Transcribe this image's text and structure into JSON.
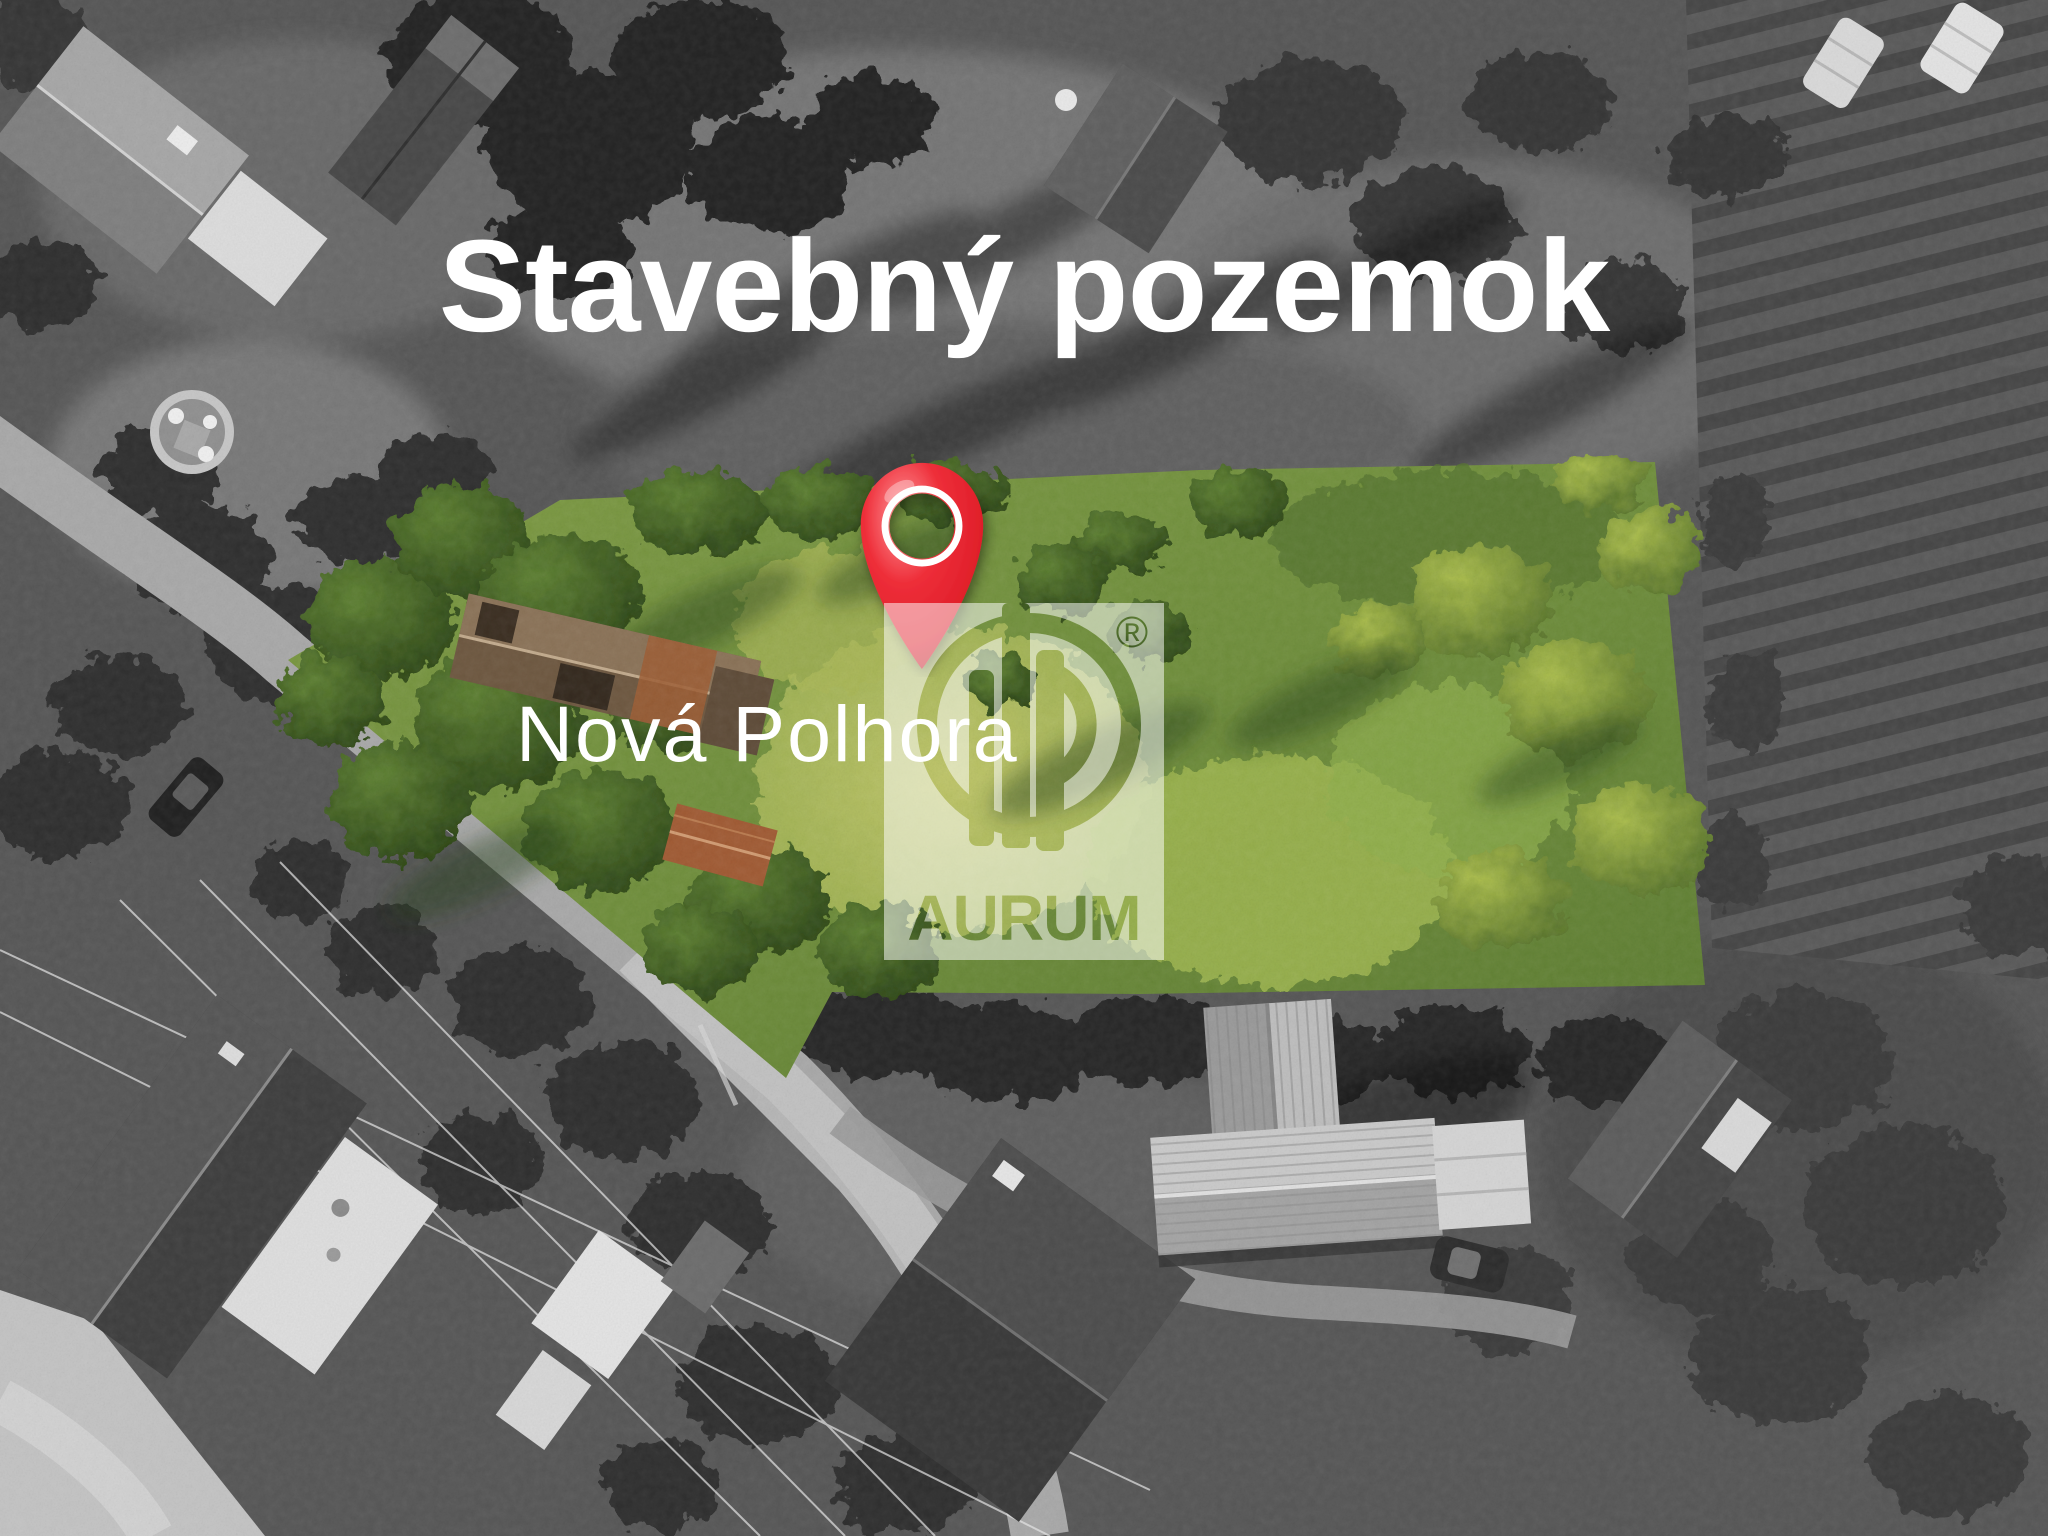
{
  "overlay": {
    "title": "Stavebný pozemok",
    "location_label": "Nová Polhora",
    "watermark": {
      "brand": "AURUM",
      "registered_mark": "®"
    }
  },
  "colors": {
    "title_text": "#ffffff",
    "location_text": "#ffffff",
    "pin_red": "#ee2e39",
    "pin_red_dark": "#b31420",
    "plot_green": "#6f8f3e",
    "plot_grass_yellow": "#bcc266",
    "plot_tree_green": "#2e4a17",
    "ruin_roof_rust": "#a05a33",
    "watermark_box": "rgba(255,255,255,0.52)",
    "photo_grayscale_base": "#585858"
  }
}
